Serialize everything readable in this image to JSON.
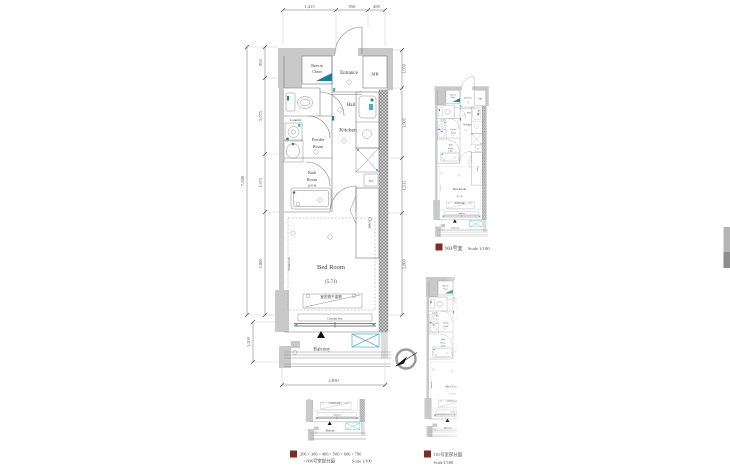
{
  "colors": {
    "background": "#ffffff",
    "wall_gray": "#c9c9c9",
    "line_gray": "#757575",
    "fixture_accent_teal": "#1e7f9b",
    "accent_light_teal": "#4ab0c4",
    "caption_marker_red": "#7d2f1f",
    "text_dark": "#3c3c3c"
  },
  "unit": {
    "rooms": {
      "shoes_in_closet": [
        "Shoes in",
        "Closet"
      ],
      "entrance": "Entrance",
      "mb": "MB",
      "hall": "Hall",
      "kitchen": "Kitchen",
      "laundry": "Laundry",
      "powder_room": [
        "Powder",
        "Room"
      ],
      "bath_room": [
        "Bath",
        "Room",
        "(1014)"
      ],
      "ps": "PS",
      "closet": "Closet",
      "bed_room": "Bed Room",
      "bed_room_size": "(5.7J)",
      "bed_room_note": "室内物干金物",
      "picture_rail": "Picture rail",
      "curtain_box": "Curtain box",
      "balcony": "Balcony"
    },
    "dimensions": {
      "top": [
        "1,415",
        "950",
        "485"
      ],
      "left_overall": "7,300",
      "left_segments": [
        "850",
        "2,075",
        "1,575",
        "2,800"
      ],
      "balcony_height": "1,200",
      "right_segments": [
        "1,050",
        "1,905",
        "1,515",
        "2,800"
      ],
      "bottom_width": "2,850"
    }
  },
  "captions": {
    "unit_904": {
      "label": "904号室",
      "scale": "Scale 1/100"
    },
    "units_206_806": {
      "line1": "206・306・406・506・606・706",
      "line2": "・806号室部分図",
      "scale": "Scale 1/100"
    },
    "unit_101": {
      "label": "101号室部分図",
      "scale": "Scale 1/100"
    }
  }
}
